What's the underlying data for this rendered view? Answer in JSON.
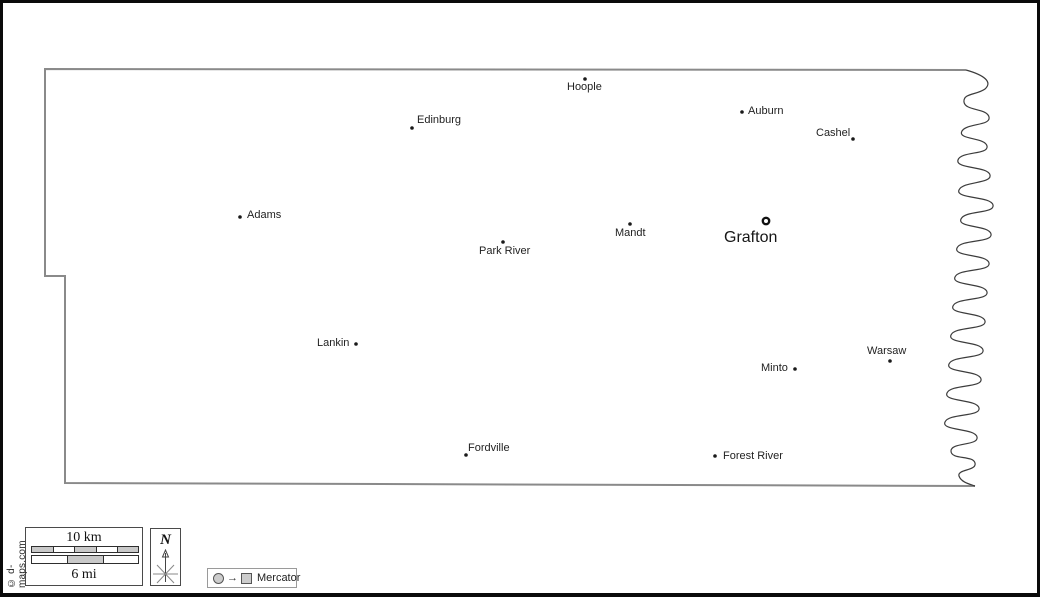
{
  "map": {
    "county_seat": {
      "name": "Grafton"
    },
    "cities": [
      {
        "name": "Hoople"
      },
      {
        "name": "Auburn"
      },
      {
        "name": "Cashel"
      },
      {
        "name": "Edinburg"
      },
      {
        "name": "Adams"
      },
      {
        "name": "Park River"
      },
      {
        "name": "Mandt"
      },
      {
        "name": "Lankin"
      },
      {
        "name": "Minto"
      },
      {
        "name": "Warsaw"
      },
      {
        "name": "Fordville"
      },
      {
        "name": "Forest River"
      }
    ]
  },
  "scale_bar": {
    "km_label": "10 km",
    "mi_label": "6 mi"
  },
  "compass": {
    "label": "N"
  },
  "projection_legend": {
    "label": "Mercator"
  },
  "credit": {
    "copyright": "© d-maps.com"
  },
  "colors": {
    "frame": "#0a0a0a",
    "county_border": "#8a8a8a",
    "river": "#3c3c3c",
    "city_dot": "#1a1a1a",
    "scale_segment_fill": "#c9c9c9",
    "background": "#ffffff"
  }
}
